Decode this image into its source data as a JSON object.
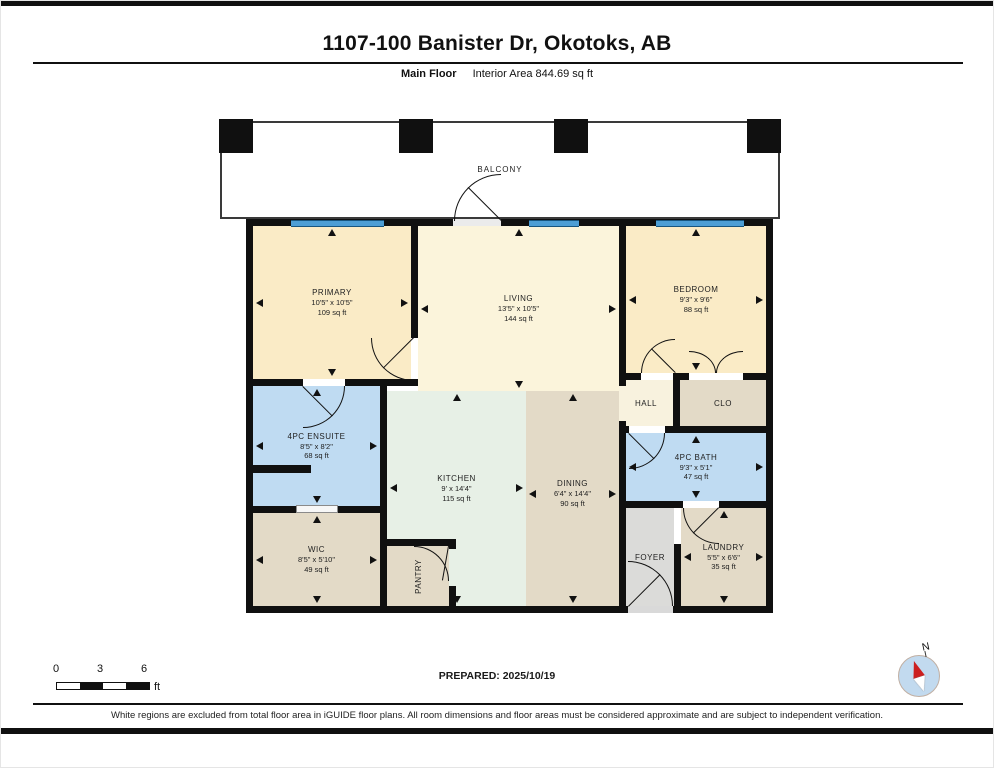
{
  "header": {
    "title": "1107-100 Banister Dr, Okotoks, AB",
    "floor_label": "Main Floor",
    "interior_area_label": "Interior Area 844.69 sq ft"
  },
  "floorplan": {
    "balcony_label": "BALCONY",
    "rooms": [
      {
        "name": "PRIMARY",
        "dims": "10'5\" x 10'5\"",
        "area": "109 sq ft"
      },
      {
        "name": "LIVING",
        "dims": "13'5\" x 10'5\"",
        "area": "144 sq ft"
      },
      {
        "name": "BEDROOM",
        "dims": "9'3\" x 9'6\"",
        "area": "88 sq ft"
      },
      {
        "name": "HALL",
        "dims": "",
        "area": ""
      },
      {
        "name": "CLO",
        "dims": "",
        "area": ""
      },
      {
        "name": "4PC ENSUITE",
        "dims": "8'5\" x 8'2\"",
        "area": "68 sq ft"
      },
      {
        "name": "KITCHEN",
        "dims": "9' x 14'4\"",
        "area": "115 sq ft"
      },
      {
        "name": "DINING",
        "dims": "6'4\" x 14'4\"",
        "area": "90 sq ft"
      },
      {
        "name": "4PC BATH",
        "dims": "9'3\" x 5'1\"",
        "area": "47 sq ft"
      },
      {
        "name": "WIC",
        "dims": "8'5\" x 5'10\"",
        "area": "49 sq ft"
      },
      {
        "name": "PANTRY",
        "dims": "",
        "area": ""
      },
      {
        "name": "FOYER",
        "dims": "",
        "area": ""
      },
      {
        "name": "LAUNDRY",
        "dims": "5'5\" x 6'6\"",
        "area": "35 sq ft"
      }
    ]
  },
  "footer": {
    "scale": {
      "tick_0": "0",
      "tick_3": "3",
      "tick_6": "6",
      "unit": "ft"
    },
    "prepared_label": "PREPARED: 2025/10/19",
    "disclaimer": "White regions are excluded from total floor area in iGUIDE floor plans. All room dimensions and floor areas must be considered approximate and are subject to independent verification.",
    "compass_label": "N"
  },
  "colors": {
    "wall": "#101010",
    "window_blue": "#4D9ED5",
    "room_cream": "#FAEBC6",
    "room_cream_light": "#FBF4DB",
    "room_blue": "#BFDBF2",
    "room_mint": "#E7F0E6",
    "room_tan": "#E3DAC7",
    "room_gray": "#DBDBD9",
    "compass_red": "#CC1F1F"
  }
}
